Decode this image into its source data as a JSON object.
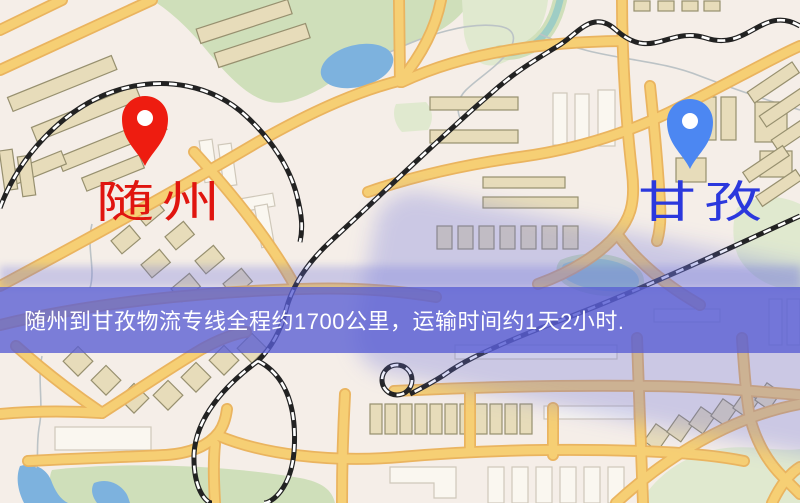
{
  "origin": {
    "label": "随州"
  },
  "destination": {
    "label": "甘孜"
  },
  "banner": {
    "text": "随州到甘孜物流专线全程约1700公里，运输时间约1天2小时."
  },
  "colors": {
    "background": "#f5eee8",
    "park": "#cfdfba",
    "park_light": "#e0e9cf",
    "water": "#7db2de",
    "water_teal": "#9ecdc5",
    "road_fill": "#f6cf74",
    "road_casing": "#eab45f",
    "path": "#bcc3c6",
    "building_fill": "#e7dcba",
    "building_stroke": "#97906f",
    "building_white": "#faf7f0",
    "building_white_stroke": "#cfc8ba",
    "railway": "#222222",
    "railway_dash": "#ffffff",
    "origin_label": "#e0150f",
    "origin_pin": "#ee1c10",
    "dest_label": "#2b38dd",
    "dest_pin": "#4c87f2",
    "pin_hole": "#ffffff",
    "band": "rgba(89,93,211,0.78)",
    "halo": "rgba(106,111,219,0.30)",
    "banner_text": "#ffffff"
  }
}
